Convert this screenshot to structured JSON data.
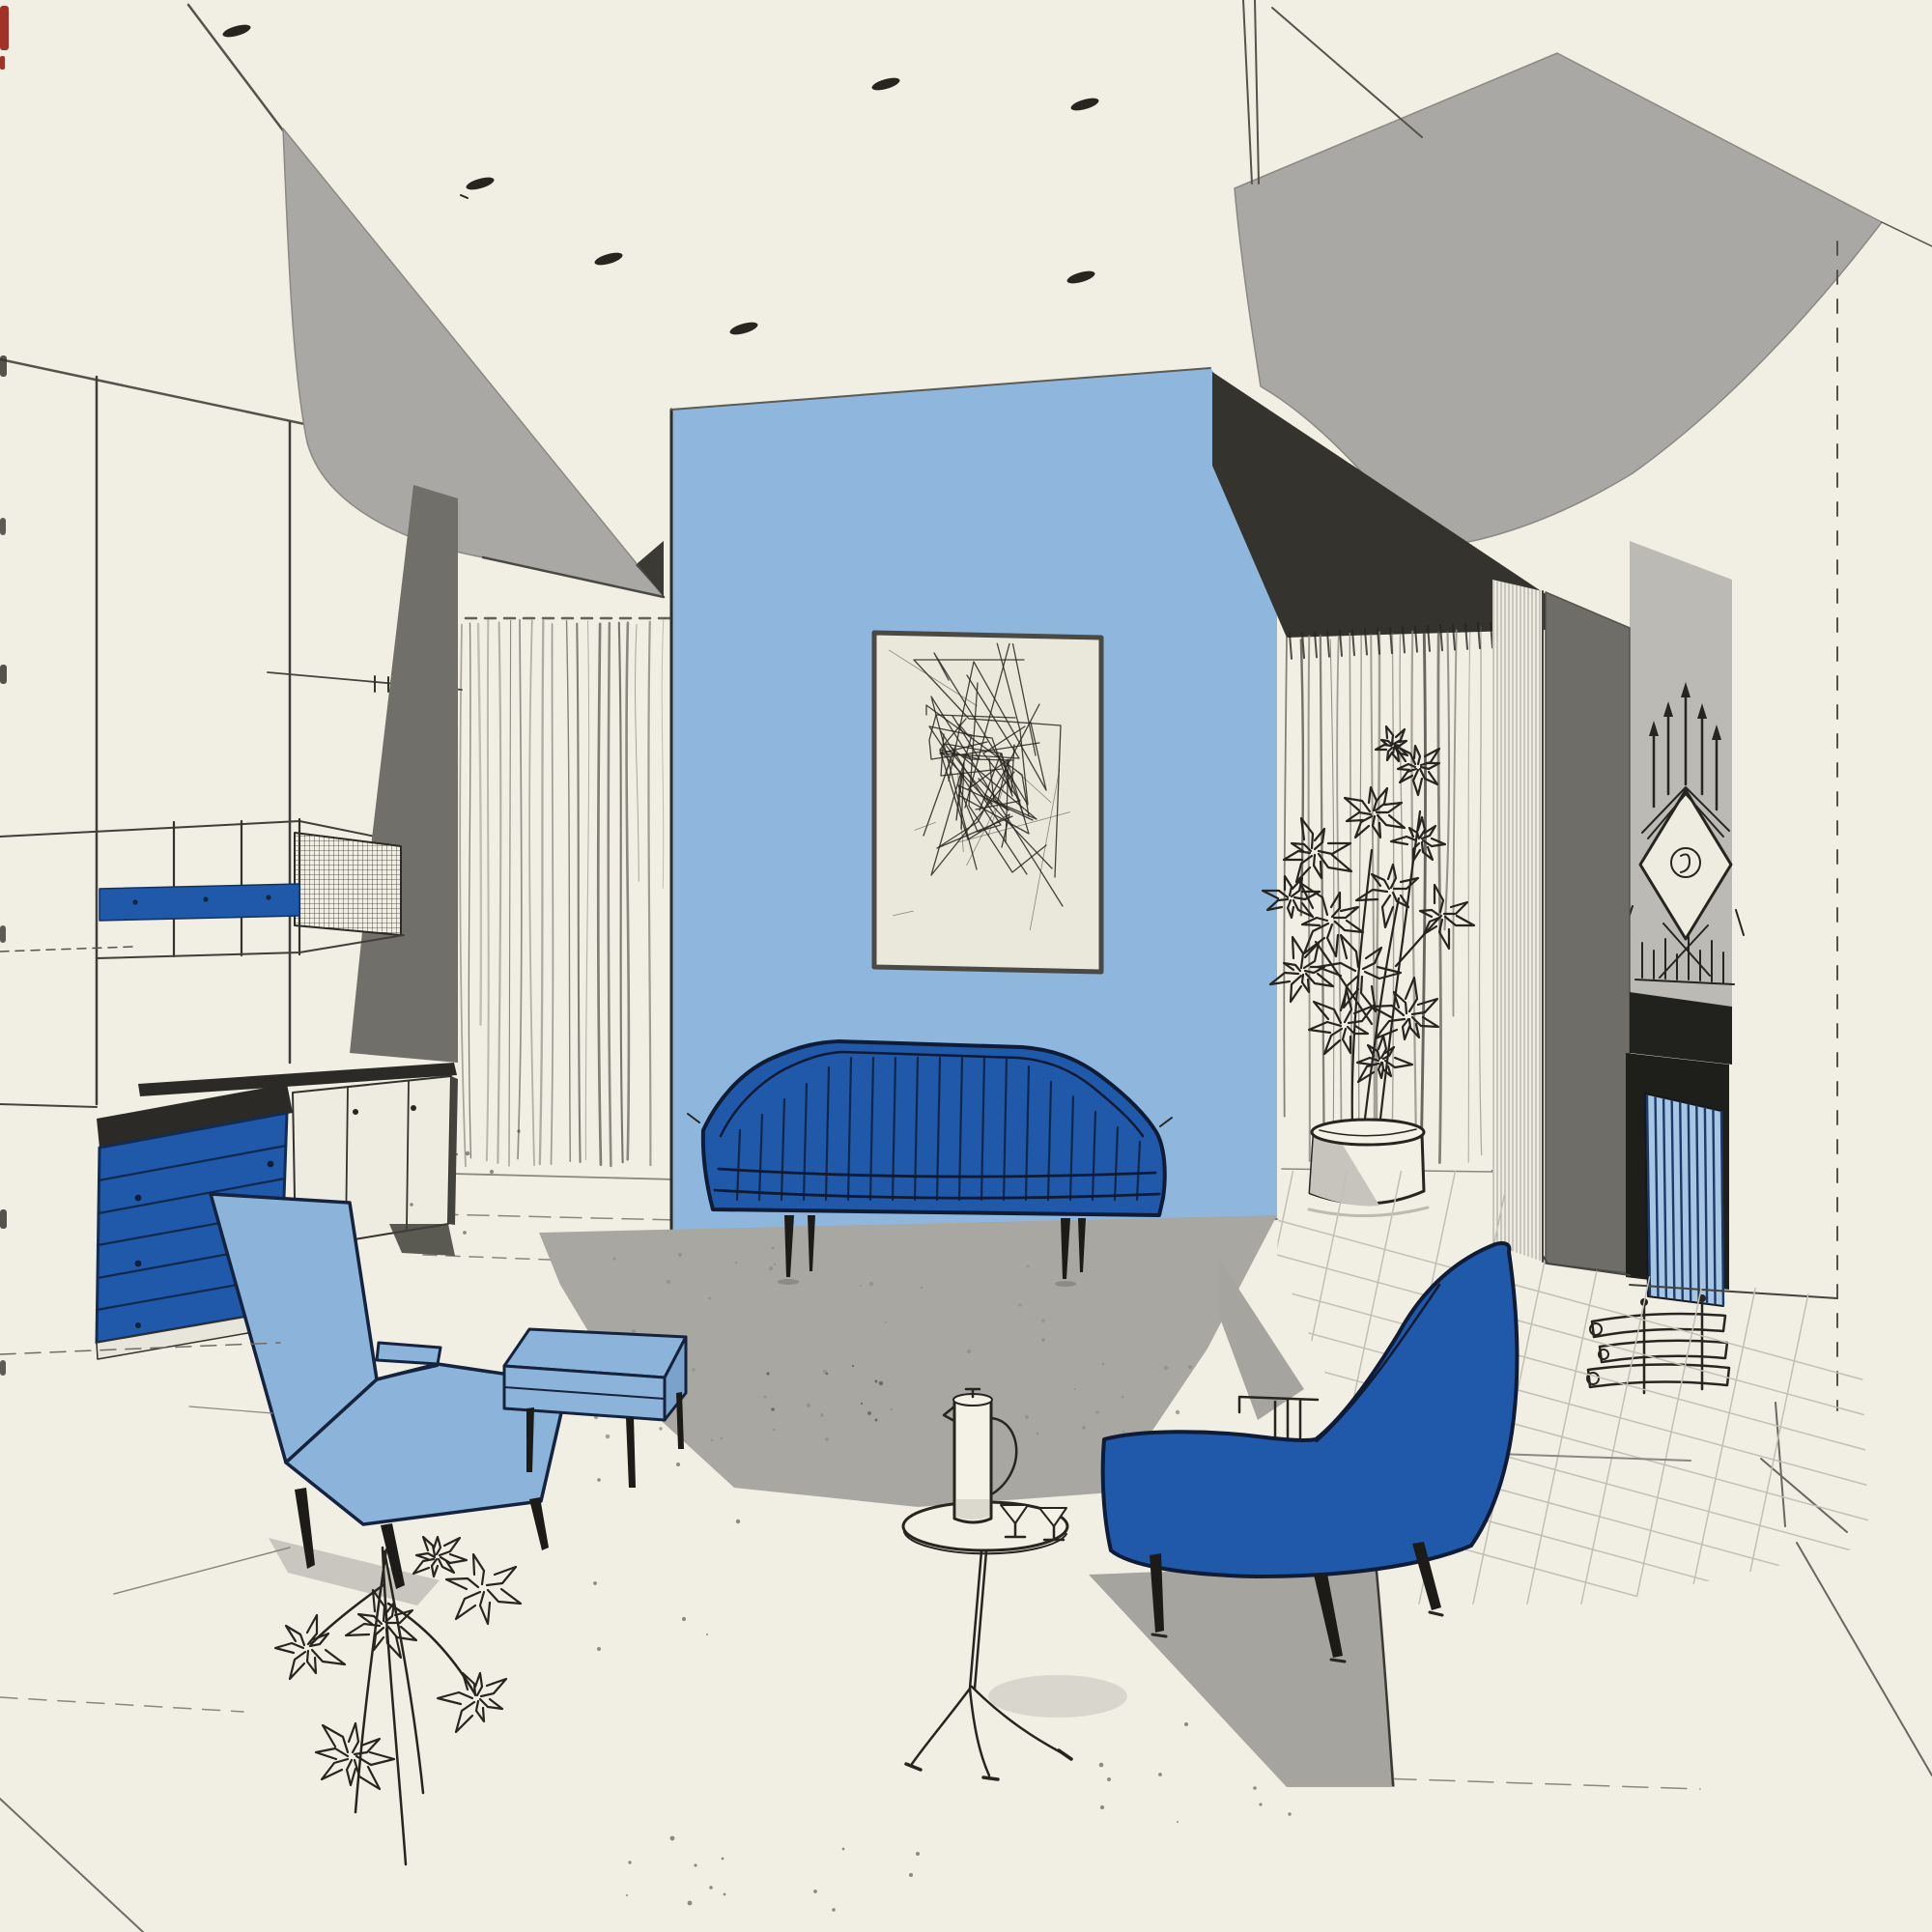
{
  "document": {
    "type": "interior-design-rendering",
    "subject": "mid-century modern living room illustration",
    "technique": "ink line drawing with flat blue and gray color fills"
  },
  "palette": {
    "paper": "#f1eee4",
    "art_paper": "#eae7db",
    "ink": "#26251f",
    "soft_ink": "#55534c",
    "accent_blue": "#2058aa",
    "accent_blue_dark": "#122c52",
    "light_blue": "#8cb4da",
    "light_blue_shade": "#7aa3cc",
    "pale_blue": "#a6c6e4",
    "wall_blue": "#8fb7de",
    "soffit_gray": "#a9a8a4",
    "deep_shadow": "#34332d",
    "panel_dark_gray": "#716f6a",
    "column_gray": "#6e6d68",
    "mantel_gray": "#bcbab4",
    "black_trim": "#21211d",
    "firebox_black": "#1e1e1a",
    "rug_gray": "#a8a7a1",
    "shadow_gray": "#c8c6bf",
    "mid_shadow": "#a5a49e",
    "tile_line": "#c2bfb5",
    "white_fill": "#f2efe5",
    "red_edge": "#a33226"
  },
  "scene": {
    "ceiling": {
      "label": "ceiling with recessed downlights",
      "light_count": 7
    },
    "left_soffit": {
      "label": "curved gray ceiling soffit, left"
    },
    "right_soffit": {
      "label": "curved gray ceiling soffit, right"
    },
    "accent_wall": {
      "label": "light blue accent wall"
    },
    "artwork": {
      "label": "framed abstract line-art panel"
    },
    "sofa": {
      "label": "channel-back sofa in accent blue",
      "channel_count": 19,
      "leg_count": 4
    },
    "armchair": {
      "label": "high-back lounge chair in light blue"
    },
    "ottoman": {
      "label": "rectangular ottoman in light blue"
    },
    "lounge_chair": {
      "label": "curved-back slipper chair in accent blue"
    },
    "side_table": {
      "label": "round tripod drinks table"
    },
    "pitcher": {
      "label": "tall cocktail pitcher"
    },
    "glasses": {
      "label": "martini glasses",
      "count": 2
    },
    "rug": {
      "label": "gray area rug set on the diagonal"
    },
    "drawer_chest": {
      "label": "blue chest of drawers",
      "drawer_count": 6
    },
    "sideboard": {
      "label": "low white sideboard",
      "door_count": 3
    },
    "shelf_unit": {
      "label": "wall-hung shelf with blue fascia band"
    },
    "grid_panel": {
      "label": "woven grid screen panel"
    },
    "dark_wall_panel": {
      "label": "dark gray wall panel"
    },
    "left_curtain": {
      "label": "floor-length drapery, left"
    },
    "right_curtain": {
      "label": "floor-length drapery, right"
    },
    "sheer_corner": {
      "label": "sheer curtain at wall corner"
    },
    "column": {
      "label": "dark gray chimney column"
    },
    "fireplace": {
      "label": "fireplace opening with striped fire screen"
    },
    "logs": {
      "label": "log set at hearth"
    },
    "clock": {
      "label": "spiked sculptural mantel clock"
    },
    "plant_large": {
      "label": "tall foliage plant in cylinder planter"
    },
    "plant_floor": {
      "label": "leafy plant sprays, foreground"
    },
    "floor": {
      "label": "pale floor with scored tile grid"
    },
    "edge_marks": {
      "label": "page binding edge marks"
    }
  }
}
